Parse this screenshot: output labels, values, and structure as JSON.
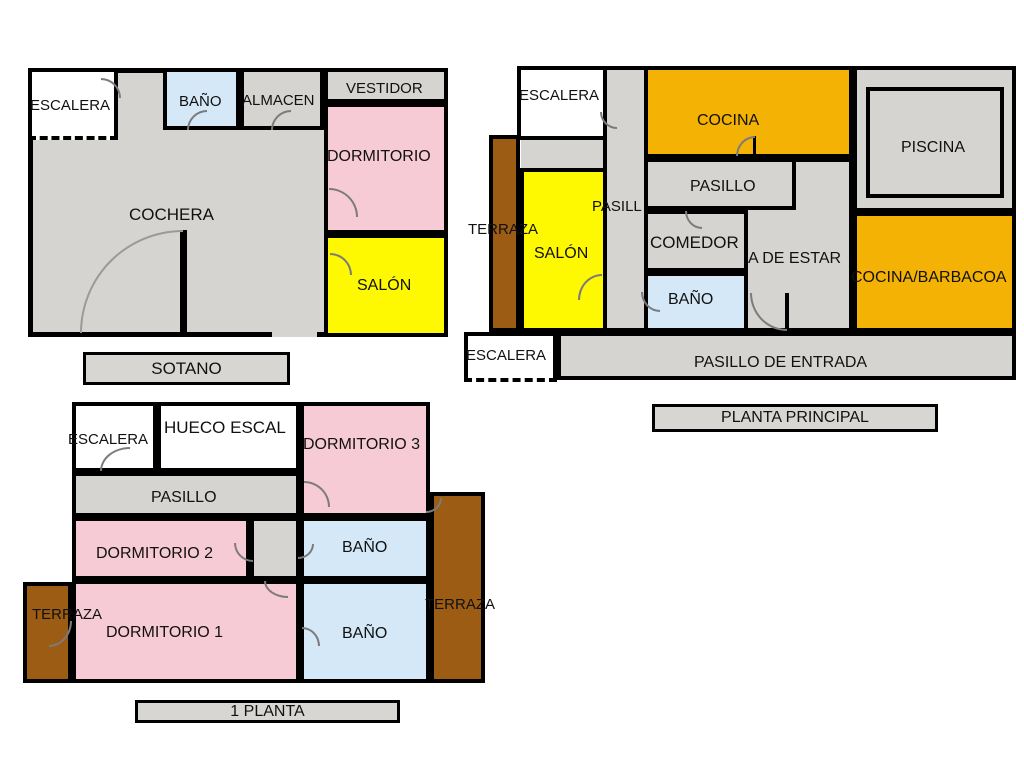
{
  "colors": {
    "gray": "#d6d4d1",
    "pink": "#f7cbd6",
    "yellow": "#fef900",
    "orange": "#f4b204",
    "blue": "#d5e8f7",
    "brown": "#9c5c13",
    "white": "#ffffff",
    "wall": "#000000",
    "arc": "#7b7b7b",
    "arc_garage": "#9a9a9a",
    "title_fill": "#d8d6d3"
  },
  "watermark": {
    "text": "CASA"
  },
  "plans": [
    {
      "id": "sotano",
      "title": "SOTANO",
      "rooms": [
        {
          "name": "cochera-base",
          "x": 28,
          "y": 68,
          "w": 420,
          "h": 269,
          "fill": "gray",
          "bw": 5
        },
        {
          "name": "escalera",
          "x": 28,
          "y": 68,
          "w": 90,
          "h": 72,
          "fill": "white",
          "bw": 4,
          "dashb": true
        },
        {
          "name": "bano",
          "x": 163,
          "y": 68,
          "w": 77,
          "h": 62,
          "fill": "blue",
          "bw": 4
        },
        {
          "name": "almacen",
          "x": 240,
          "y": 68,
          "w": 84,
          "h": 62,
          "fill": "gray",
          "bw": 4
        },
        {
          "name": "vestidor",
          "x": 324,
          "y": 68,
          "w": 124,
          "h": 35,
          "fill": "gray",
          "bw": 4
        },
        {
          "name": "dormitorio",
          "x": 324,
          "y": 103,
          "w": 124,
          "h": 131,
          "fill": "pink",
          "bw": 4
        },
        {
          "name": "salon",
          "x": 324,
          "y": 234,
          "w": 124,
          "h": 103,
          "fill": "yellow",
          "bw": 4
        }
      ],
      "walls": [
        {
          "name": "garage-wall",
          "x": 180,
          "y": 230,
          "w": 7,
          "h": 107
        }
      ],
      "gaps": [
        {
          "name": "garage-opening",
          "x": 272,
          "y": 331,
          "w": 45,
          "h": 6,
          "fill": "gray"
        }
      ],
      "arcs": [
        {
          "name": "escalera-door",
          "x": 101,
          "y": 78,
          "w": 20,
          "h": 20,
          "corner": "tr"
        },
        {
          "name": "bano-door",
          "x": 187,
          "y": 110,
          "w": 20,
          "h": 20,
          "corner": "tl"
        },
        {
          "name": "almacen-door",
          "x": 271,
          "y": 110,
          "w": 20,
          "h": 20,
          "corner": "tl"
        },
        {
          "name": "dormitorio-door",
          "x": 329,
          "y": 188,
          "w": 29,
          "h": 29,
          "corner": "tr"
        },
        {
          "name": "salon-door",
          "x": 330,
          "y": 253,
          "w": 22,
          "h": 22,
          "corner": "tr"
        },
        {
          "name": "garage-door",
          "x": 80,
          "y": 230,
          "w": 103,
          "h": 103,
          "corner": "tl",
          "garage": true
        }
      ],
      "labels": [
        {
          "name": "escalera-label",
          "text": "ESCALERA",
          "x": 30,
          "y": 98,
          "fs": 15
        },
        {
          "name": "bano-label",
          "text": "BAÑO",
          "x": 179,
          "y": 94,
          "fs": 15
        },
        {
          "name": "almacen-label",
          "text": "ALMACEN",
          "x": 242,
          "y": 93,
          "fs": 15
        },
        {
          "name": "vestidor-label",
          "text": "VESTIDOR",
          "x": 346,
          "y": 81,
          "fs": 15
        },
        {
          "name": "dormitorio-label",
          "text": "DORMITORIO",
          "x": 327,
          "y": 148,
          "fs": 16
        },
        {
          "name": "cochera-label",
          "text": "COCHERA",
          "x": 129,
          "y": 206,
          "fs": 17
        },
        {
          "name": "salon-label",
          "text": "SALÓN",
          "x": 357,
          "y": 277,
          "fs": 16
        }
      ]
    },
    {
      "id": "principal",
      "title": "PLANTA PRINCIPAL",
      "rooms": [
        {
          "name": "terraza",
          "x": 489,
          "y": 135,
          "w": 31,
          "h": 197,
          "fill": "brown",
          "bw": 4
        },
        {
          "name": "escalera-top",
          "x": 517,
          "y": 66,
          "w": 90,
          "h": 74,
          "fill": "white",
          "bw": 4
        },
        {
          "name": "landing",
          "x": 521,
          "y": 140,
          "w": 85,
          "h": 28,
          "fill": "gray",
          "bw": 0
        },
        {
          "name": "corridor",
          "x": 603,
          "y": 66,
          "w": 45,
          "h": 266,
          "fill": "gray",
          "bw": 4
        },
        {
          "name": "salon",
          "x": 520,
          "y": 168,
          "w": 87,
          "h": 164,
          "fill": "yellow",
          "bw": 4
        },
        {
          "name": "cocina",
          "x": 644,
          "y": 66,
          "w": 209,
          "h": 92,
          "fill": "orange",
          "bw": 4
        },
        {
          "name": "sala-de-estar",
          "x": 744,
          "y": 158,
          "w": 109,
          "h": 174,
          "fill": "gray",
          "bw": 4
        },
        {
          "name": "pasillo",
          "x": 644,
          "y": 158,
          "w": 152,
          "h": 52,
          "fill": "gray",
          "bw": 4
        },
        {
          "name": "comedor",
          "x": 644,
          "y": 210,
          "w": 104,
          "h": 62,
          "fill": "gray",
          "bw": 4
        },
        {
          "name": "bano",
          "x": 644,
          "y": 272,
          "w": 104,
          "h": 60,
          "fill": "blue",
          "bw": 4
        },
        {
          "name": "piscina-zona",
          "x": 853,
          "y": 66,
          "w": 163,
          "h": 146,
          "fill": "gray",
          "bw": 4
        },
        {
          "name": "piscina",
          "x": 866,
          "y": 87,
          "w": 138,
          "h": 111,
          "fill": "gray",
          "bw": 4
        },
        {
          "name": "cocina-barbacoa",
          "x": 853,
          "y": 212,
          "w": 163,
          "h": 120,
          "fill": "orange",
          "bw": 4
        },
        {
          "name": "pasillo-entrada",
          "x": 557,
          "y": 332,
          "w": 459,
          "h": 48,
          "fill": "gray",
          "bw": 4
        },
        {
          "name": "escalera-bottom",
          "x": 464,
          "y": 332,
          "w": 93,
          "h": 50,
          "fill": "white",
          "bw": 4,
          "dashb": true
        }
      ],
      "walls": [
        {
          "name": "sala-door-leaf",
          "x": 785,
          "y": 293,
          "w": 4,
          "h": 37
        },
        {
          "name": "cocina-door-leaf",
          "x": 753,
          "y": 136,
          "w": 3,
          "h": 21
        }
      ],
      "gaps": [],
      "arcs": [
        {
          "name": "escalera-door",
          "x": 600,
          "y": 112,
          "w": 17,
          "h": 17,
          "corner": "bl"
        },
        {
          "name": "cocina-door",
          "x": 736,
          "y": 136,
          "w": 19,
          "h": 20,
          "corner": "tl"
        },
        {
          "name": "comedor-door",
          "x": 685,
          "y": 211,
          "w": 17,
          "h": 18,
          "corner": "bl"
        },
        {
          "name": "bano-door",
          "x": 641,
          "y": 292,
          "w": 19,
          "h": 20,
          "corner": "bl"
        },
        {
          "name": "salon-door",
          "x": 578,
          "y": 274,
          "w": 24,
          "h": 26,
          "corner": "tl"
        },
        {
          "name": "entrada-door",
          "x": 750,
          "y": 293,
          "w": 37,
          "h": 38,
          "corner": "bl"
        }
      ],
      "labels": [
        {
          "name": "escalera-top-label",
          "text": "ESCALERA",
          "x": 519,
          "y": 88,
          "fs": 15
        },
        {
          "name": "terraza-label",
          "text": "TERRAZA",
          "x": 468,
          "y": 222,
          "fs": 15
        },
        {
          "name": "pasillo-v-label",
          "text": "PASILL",
          "x": 592,
          "y": 199,
          "fs": 15
        },
        {
          "name": "salon-label",
          "text": "SALÓN",
          "x": 534,
          "y": 245,
          "fs": 16
        },
        {
          "name": "cocina-label",
          "text": "COCINA",
          "x": 697,
          "y": 112,
          "fs": 16
        },
        {
          "name": "pasillo-label",
          "text": "PASILLO",
          "x": 690,
          "y": 178,
          "fs": 16
        },
        {
          "name": "comedor-label",
          "text": "COMEDOR",
          "x": 650,
          "y": 234,
          "fs": 17
        },
        {
          "name": "sala-de-estar-label",
          "text": "A DE ESTAR",
          "x": 748,
          "y": 250,
          "fs": 16
        },
        {
          "name": "bano-label",
          "text": "BAÑO",
          "x": 668,
          "y": 291,
          "fs": 16
        },
        {
          "name": "piscina-label",
          "text": "PISCINA",
          "x": 901,
          "y": 139,
          "fs": 16
        },
        {
          "name": "cocina-barbacoa-label",
          "text": "COCINA/BARBACOA",
          "x": 851,
          "y": 269,
          "fs": 16
        },
        {
          "name": "escalera-bottom-label",
          "text": "ESCALERA",
          "x": 466,
          "y": 348,
          "fs": 15
        },
        {
          "name": "pasillo-entrada-label",
          "text": "PASILLO DE ENTRADA",
          "x": 694,
          "y": 354,
          "fs": 16
        }
      ]
    },
    {
      "id": "planta1",
      "title": "1 PLANTA",
      "rooms": [
        {
          "name": "terraza-izq",
          "x": 23,
          "y": 582,
          "w": 49,
          "h": 101,
          "fill": "brown",
          "bw": 4
        },
        {
          "name": "terraza-der",
          "x": 430,
          "y": 492,
          "w": 55,
          "h": 191,
          "fill": "brown",
          "bw": 4
        },
        {
          "name": "escalera",
          "x": 72,
          "y": 402,
          "w": 85,
          "h": 70,
          "fill": "white",
          "bw": 4
        },
        {
          "name": "hueco-escal",
          "x": 157,
          "y": 402,
          "w": 143,
          "h": 70,
          "fill": "white",
          "bw": 4
        },
        {
          "name": "dormitorio3",
          "x": 300,
          "y": 402,
          "w": 130,
          "h": 115,
          "fill": "pink",
          "bw": 4
        },
        {
          "name": "pasillo",
          "x": 72,
          "y": 472,
          "w": 228,
          "h": 45,
          "fill": "gray",
          "bw": 4
        },
        {
          "name": "dormitorio2",
          "x": 72,
          "y": 517,
          "w": 178,
          "h": 63,
          "fill": "pink",
          "bw": 4
        },
        {
          "name": "vestibulo",
          "x": 250,
          "y": 517,
          "w": 50,
          "h": 63,
          "fill": "gray",
          "bw": 4
        },
        {
          "name": "bano-sup",
          "x": 300,
          "y": 517,
          "w": 130,
          "h": 63,
          "fill": "blue",
          "bw": 4
        },
        {
          "name": "dormitorio1",
          "x": 72,
          "y": 580,
          "w": 228,
          "h": 103,
          "fill": "pink",
          "bw": 4
        },
        {
          "name": "bano-inf",
          "x": 300,
          "y": 580,
          "w": 130,
          "h": 103,
          "fill": "blue",
          "bw": 4
        }
      ],
      "walls": [],
      "gaps": [],
      "arcs": [
        {
          "name": "escalera-door",
          "x": 100,
          "y": 447,
          "w": 30,
          "h": 24,
          "corner": "tl"
        },
        {
          "name": "dorm3-door",
          "x": 304,
          "y": 481,
          "w": 26,
          "h": 26,
          "corner": "tr"
        },
        {
          "name": "dorm3-terraza-door",
          "x": 426,
          "y": 498,
          "w": 16,
          "h": 15,
          "corner": "br"
        },
        {
          "name": "dorm2-door",
          "x": 234,
          "y": 543,
          "w": 19,
          "h": 19,
          "corner": "bl"
        },
        {
          "name": "vestibulo-bano-door",
          "x": 298,
          "y": 544,
          "w": 16,
          "h": 15,
          "corner": "br"
        },
        {
          "name": "vestibulo-dorm1-door",
          "x": 264,
          "y": 581,
          "w": 24,
          "h": 17,
          "corner": "bl"
        },
        {
          "name": "terraza-izq-door",
          "x": 49,
          "y": 621,
          "w": 23,
          "h": 26,
          "corner": "br"
        },
        {
          "name": "bano-inf-door",
          "x": 302,
          "y": 627,
          "w": 18,
          "h": 19,
          "corner": "tr"
        }
      ],
      "labels": [
        {
          "name": "escalera-label",
          "text": "ESCALERA",
          "x": 68,
          "y": 432,
          "fs": 15
        },
        {
          "name": "hueco-escal-label",
          "text": "HUECO  ESCAL",
          "x": 164,
          "y": 419,
          "fs": 17
        },
        {
          "name": "dormitorio3-label",
          "text": "DORMITORIO 3",
          "x": 303,
          "y": 436,
          "fs": 16
        },
        {
          "name": "pasillo-label",
          "text": "PASILLO",
          "x": 151,
          "y": 489,
          "fs": 16
        },
        {
          "name": "dormitorio2-label",
          "text": "DORMITORIO 2",
          "x": 96,
          "y": 545,
          "fs": 16
        },
        {
          "name": "bano-sup-label",
          "text": "BAÑO",
          "x": 342,
          "y": 539,
          "fs": 16
        },
        {
          "name": "terraza-der-label",
          "text": "TERRAZA",
          "x": 425,
          "y": 597,
          "fs": 15
        },
        {
          "name": "terraza-izq-label",
          "text": "TERRAZA",
          "x": 32,
          "y": 607,
          "fs": 15
        },
        {
          "name": "dormitorio1-label",
          "text": "DORMITORIO 1",
          "x": 106,
          "y": 624,
          "fs": 16
        },
        {
          "name": "bano-inf-label",
          "text": "BAÑO",
          "x": 342,
          "y": 625,
          "fs": 16
        }
      ]
    }
  ]
}
